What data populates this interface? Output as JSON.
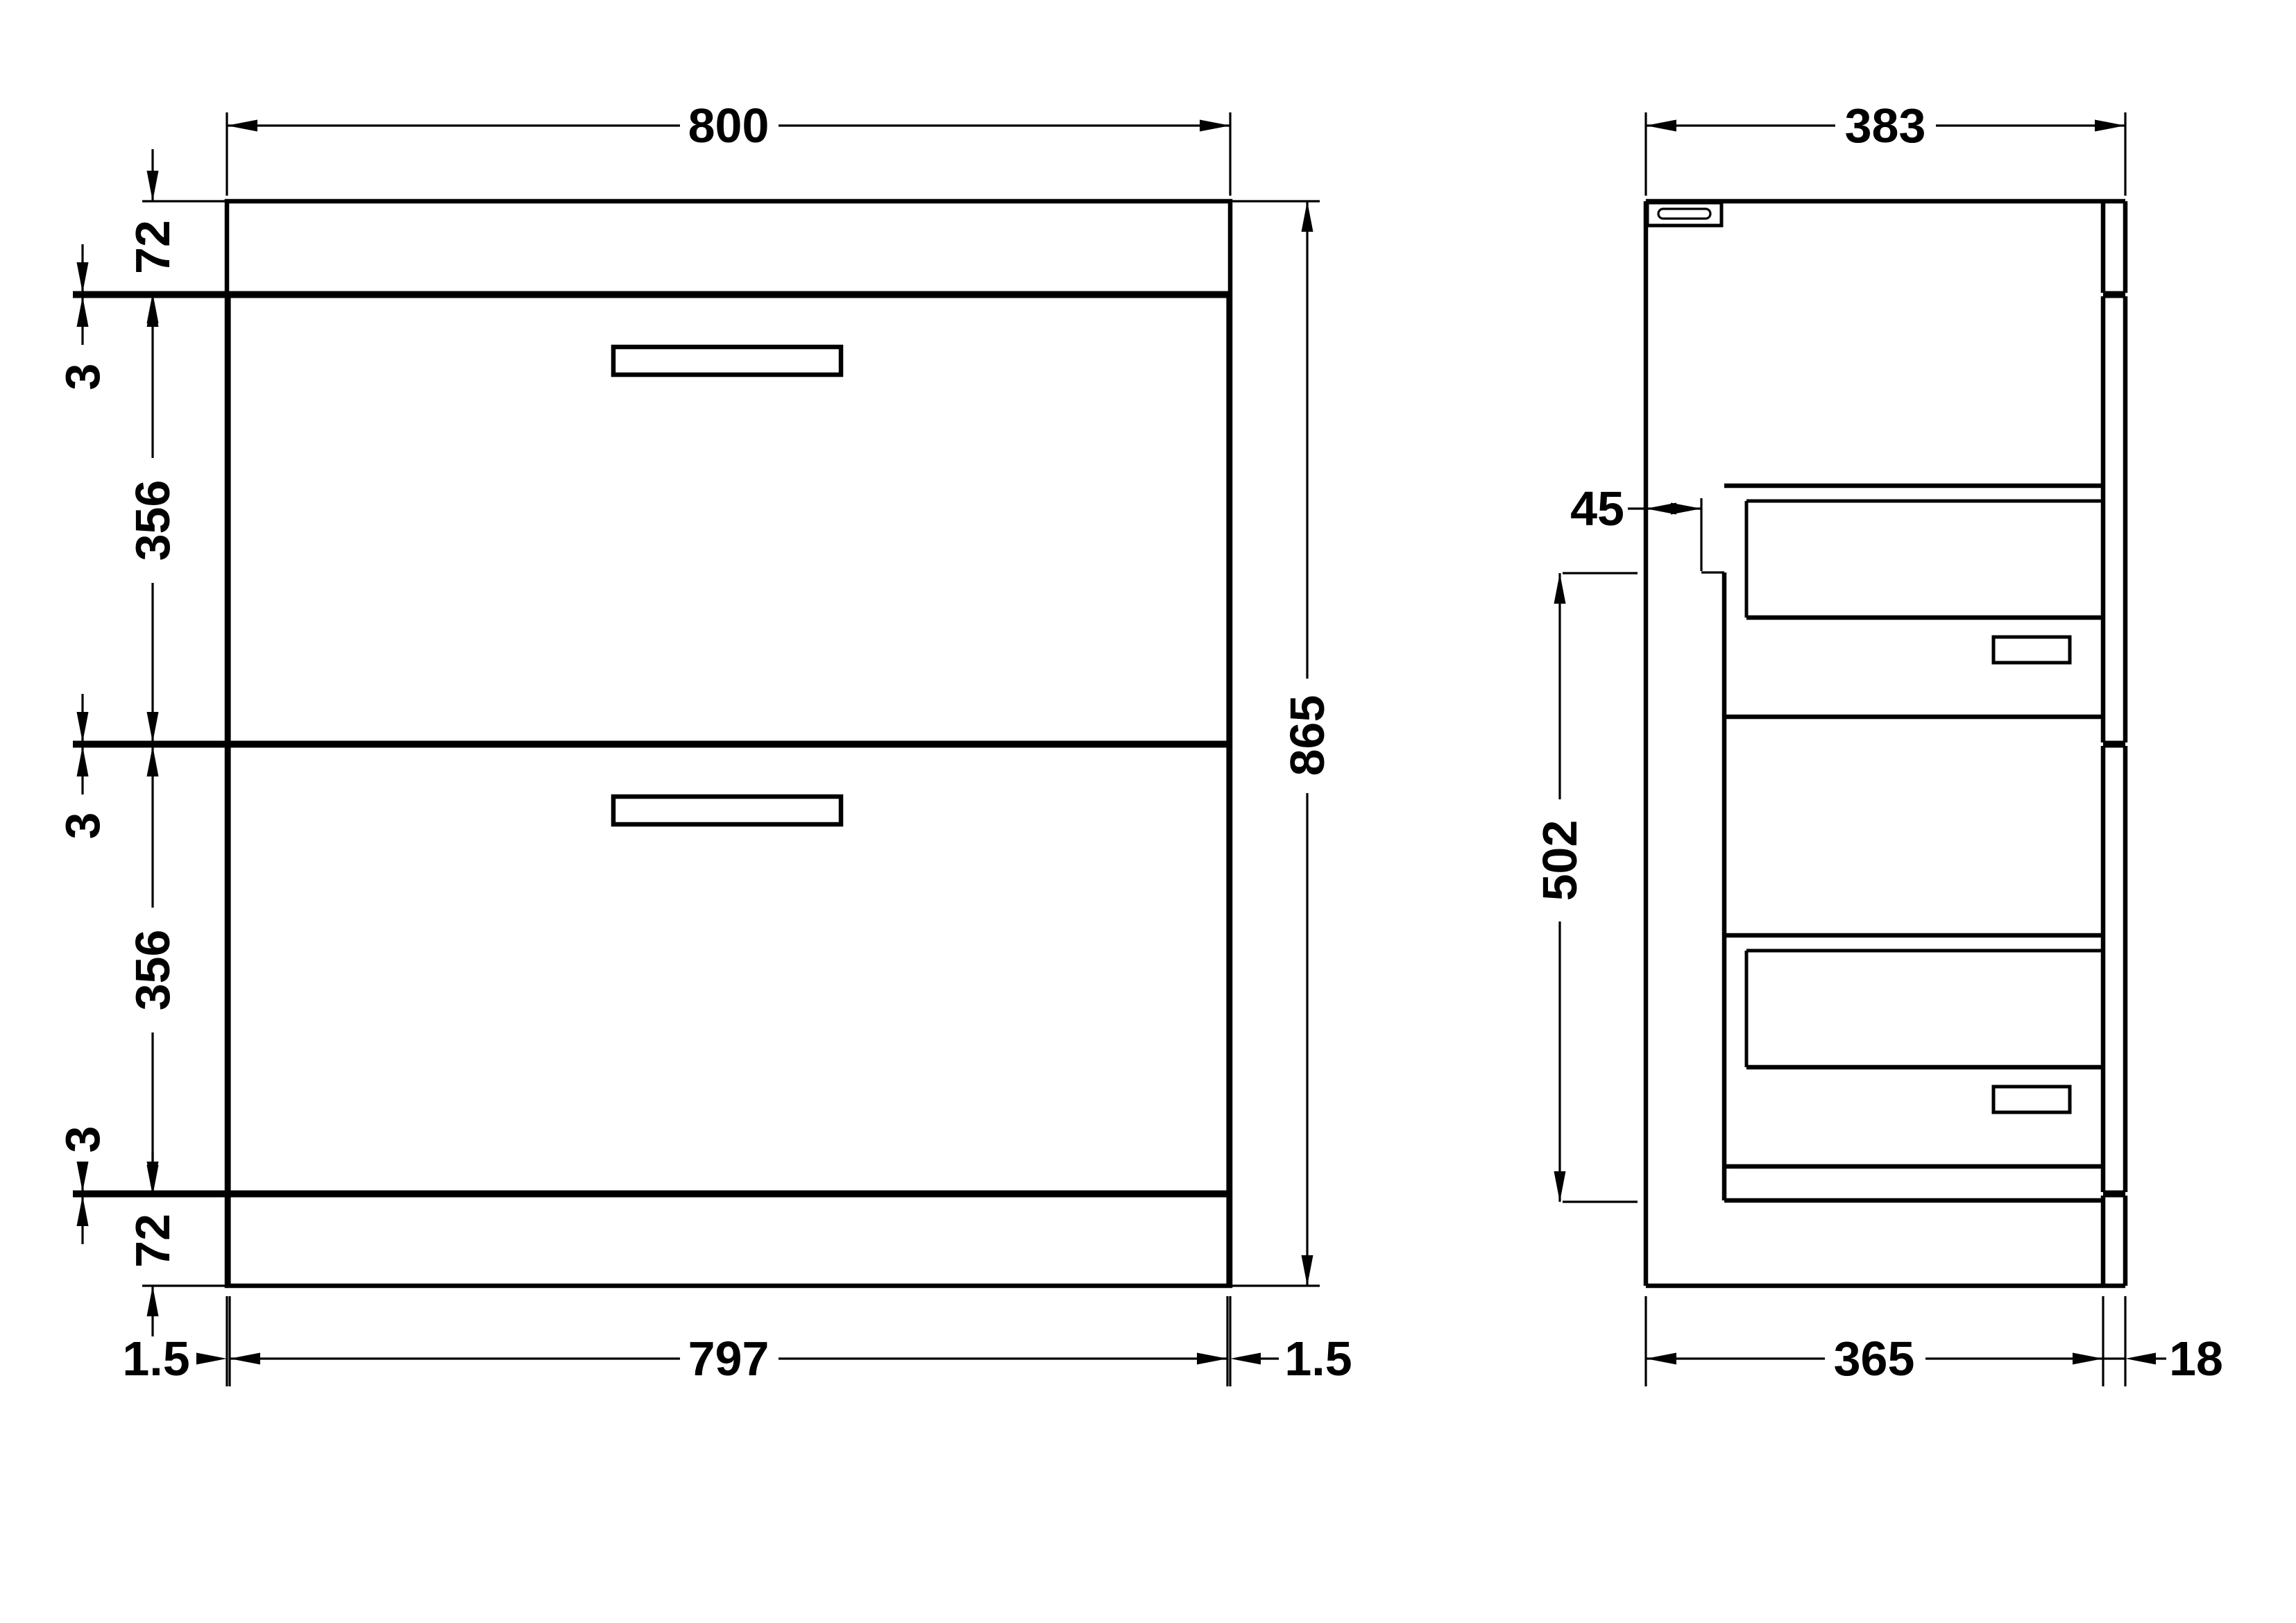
{
  "document": {
    "kind": "furniture technical drawing, two orthographic views of a two-drawer vanity unit",
    "units": "mm",
    "background_color": "#ffffff",
    "line_color": "#000000"
  },
  "dims": {
    "front_width": "800",
    "front_height": "865",
    "front_top_rail": "72",
    "front_gap_top": "3",
    "front_drawer1": "356",
    "front_gap_mid": "3",
    "front_drawer2": "356",
    "front_gap_bot": "3",
    "front_bottom_rail": "72",
    "front_inset_left": "1.5",
    "front_carcass_width": "797",
    "front_inset_right": "1.5",
    "side_depth": "383",
    "side_back_clearance": "45",
    "side_internal_height": "502",
    "side_carcass_depth": "365",
    "side_front_thickness": "18"
  }
}
